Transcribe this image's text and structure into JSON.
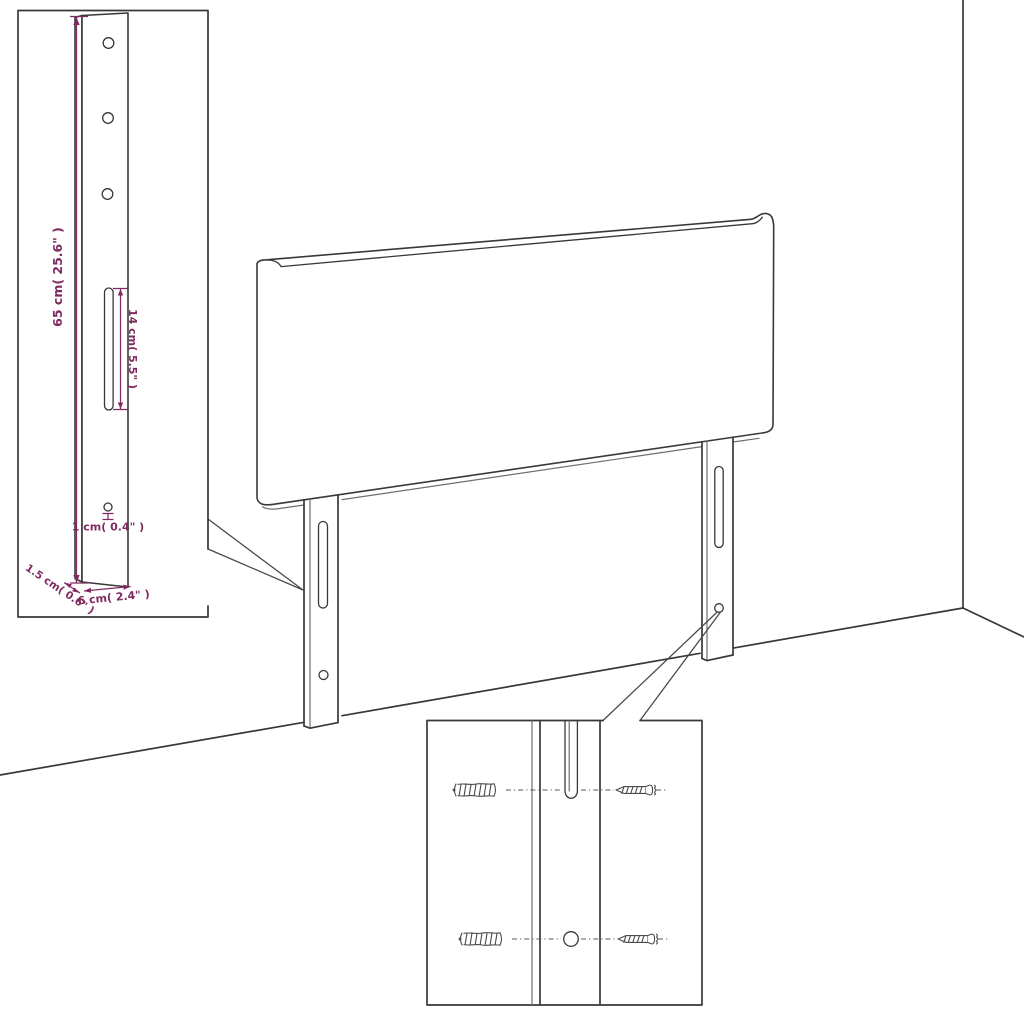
{
  "colors": {
    "line": "#383838",
    "line_light": "#6e6e6e",
    "sketch": "#4a4a4a",
    "dimension": "#7f2a60",
    "background": "#ffffff"
  },
  "bracket_inset": {
    "hole_count": 3,
    "labels": {
      "height": "65 cm( 25.6\" )",
      "slot_length": "14 cm( 5.5\" )",
      "hole_diameter": "1 cm( 0.4\" )",
      "thickness": "1.5 cm( 0.6\" )",
      "width": "6 cm( 2.4\" )"
    }
  },
  "mounting_inset": {
    "rows": 2,
    "icons": {
      "wall_plug": "wall-plug-icon",
      "screw": "screw-icon",
      "mounting_hole": "mounting-hole",
      "mounting_slot": "mounting-slot"
    }
  }
}
